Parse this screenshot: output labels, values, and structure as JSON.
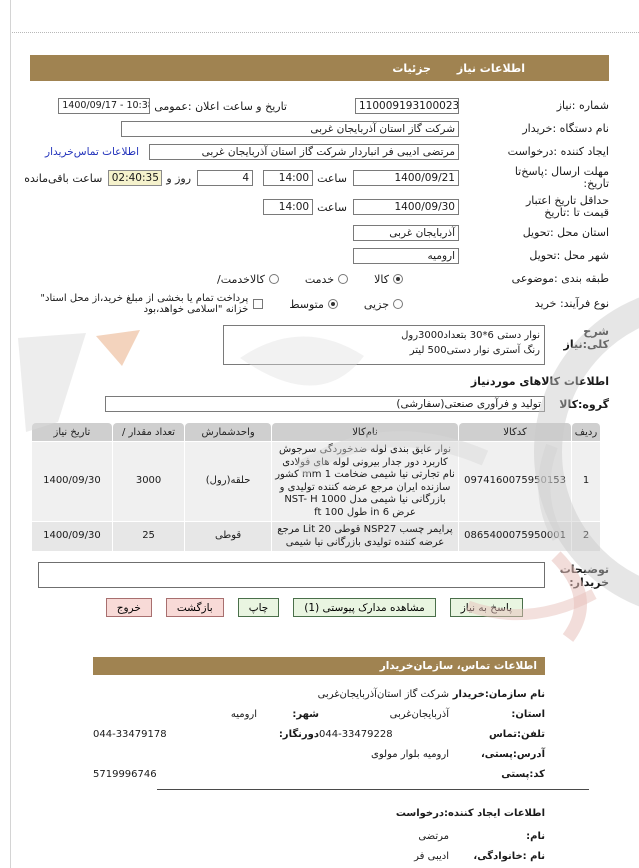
{
  "menubar": {
    "tab_need_info": "اطلاعات نیاز",
    "tab_details": "جزئیات"
  },
  "form": {
    "need_number_label": "شماره :نیاز",
    "need_number": "1100091931000230",
    "announce_label": "تاریخ و ساعت اعلان :عمومی",
    "announce_value": "1400/09/17 - 10:38",
    "org_label": "نام دستگاه :خریدار",
    "org_value": "شرکت گاز استان آذربایجان غربی",
    "creator_label": "ایجاد کننده :درخواست",
    "creator_value": "مرتضی ادیبی فر انباردار شرکت گاز استان آذربایجان غربی",
    "creator_link": "اطلاعات تماس‌خریدار",
    "deadline_label1": "مهلت ارسال :پاسخ‌تا",
    "deadline_label2": "تاریخ:",
    "deadline_date": "1400/09/21",
    "hour_label": "ساعت",
    "deadline_hour": "14:00",
    "deadline_days": "4",
    "days_label": "روز و",
    "countdown": "02:40:35",
    "remaining_label": "ساعت باقی‌مانده",
    "validity_label1": "حداقل  تاریخ اعتبار",
    "validity_label2": "قیمت تا :تاریخ",
    "validity_date": "1400/09/30",
    "validity_hour": "14:00",
    "province_label": "استان محل :تحویل",
    "province_value": "آذربایجان غربی",
    "city_label": "شهر محل :تحویل",
    "city_value": "ارومیه",
    "class_label": "طبقه بندی :موضوعی",
    "class_opt1": "کالا",
    "class_opt2": "خدمت",
    "class_opt3": "کالاخدمت/",
    "process_label": "نوع فرآیند: خرید",
    "process_opt1": "جزیی",
    "process_opt2": "متوسط",
    "treasury_label": "پرداخت تمام یا بخشی از مبلغ خرید،از محل اسناد\" خزانه \"اسلامی خواهد،بود",
    "desc_label": "شرح کلی:نیاز",
    "desc_line1": "نوار  دستی 6*30 بتعداد3000رول",
    "desc_line2": "رنگ  آستری نوار  دستی500 لیتر",
    "goods_header": "اطلاعات  کالاهای موردنیاز",
    "group_label": "گروه:کالا",
    "group_value": "تولید و فرآوری صنعتی(سفارشی)",
    "notes_label1": "توضیحات",
    "notes_label2": "خریدار:"
  },
  "table": {
    "headers": {
      "row": "ردیف",
      "code": "کدکالا",
      "name": "نام‌کالا",
      "unit": "واحدشمارش",
      "qty": "تعداد مقدار /",
      "date": "تاریخ نیاز"
    },
    "rows": [
      {
        "row": "1",
        "code": "0974160075950153",
        "name": "نوار عایق بندی لوله ضدخوردگی سرجوش کاربرد دور جدار بیرونی لوله های فولادی نام تجارتی نیا شیمی  ضخامت 1 mm کشور سازنده ایران مرجع عرضه کننده تولیدی و بازرگانی نیا شیمی مدل NST- H 1000 عرض 6 in طول 100 ft",
        "unit": "حلقه(رول)",
        "qty": "3000",
        "date": "1400/09/30"
      },
      {
        "row": "2",
        "code": "0865400075950001",
        "name": "پرایمر چسب  NSP27 قوطی 20 Lit مرجع عرضه کننده تولیدی بازرگانی نیا شیمی",
        "unit": "قوطی",
        "qty": "25",
        "date": "1400/09/30"
      }
    ]
  },
  "buttons": {
    "respond": "پاسخ به نیاز",
    "view_docs": "مشاهده مدارک پیوستی (1)",
    "print": "چاپ",
    "back": "بازگشت",
    "exit": "خروج"
  },
  "contact": {
    "header": "اطلاعات  تماس، سازمان‌خریدار",
    "org_label": "نام سازمان:خریدار",
    "org_value": "شرکت گاز استان‌آذربایجان‌غربی",
    "province_label": "استان:",
    "province": "آذربایجان‌غربی",
    "city_label": "شهر:",
    "city": "ارومیه",
    "phone_label": "تلفن:تماس",
    "phone": "044-33479228",
    "fax_label": "دورنگار:",
    "fax": "044-33479178",
    "address_label": "آدرس:پستی،",
    "address": "ارومیه بلوار مولوی",
    "postal_label": "کد:پستی",
    "postal": "5719996746"
  },
  "creator_info": {
    "header": "اطلاعات ایجاد کننده:درخواست",
    "first_name_label": "نام:",
    "first_name": "مرتضی",
    "last_name_label": "نام :خانوادگی،",
    "last_name": "ادیبی فر",
    "phone_label": "تلفن:تماس",
    "phone": "044-31998611"
  }
}
